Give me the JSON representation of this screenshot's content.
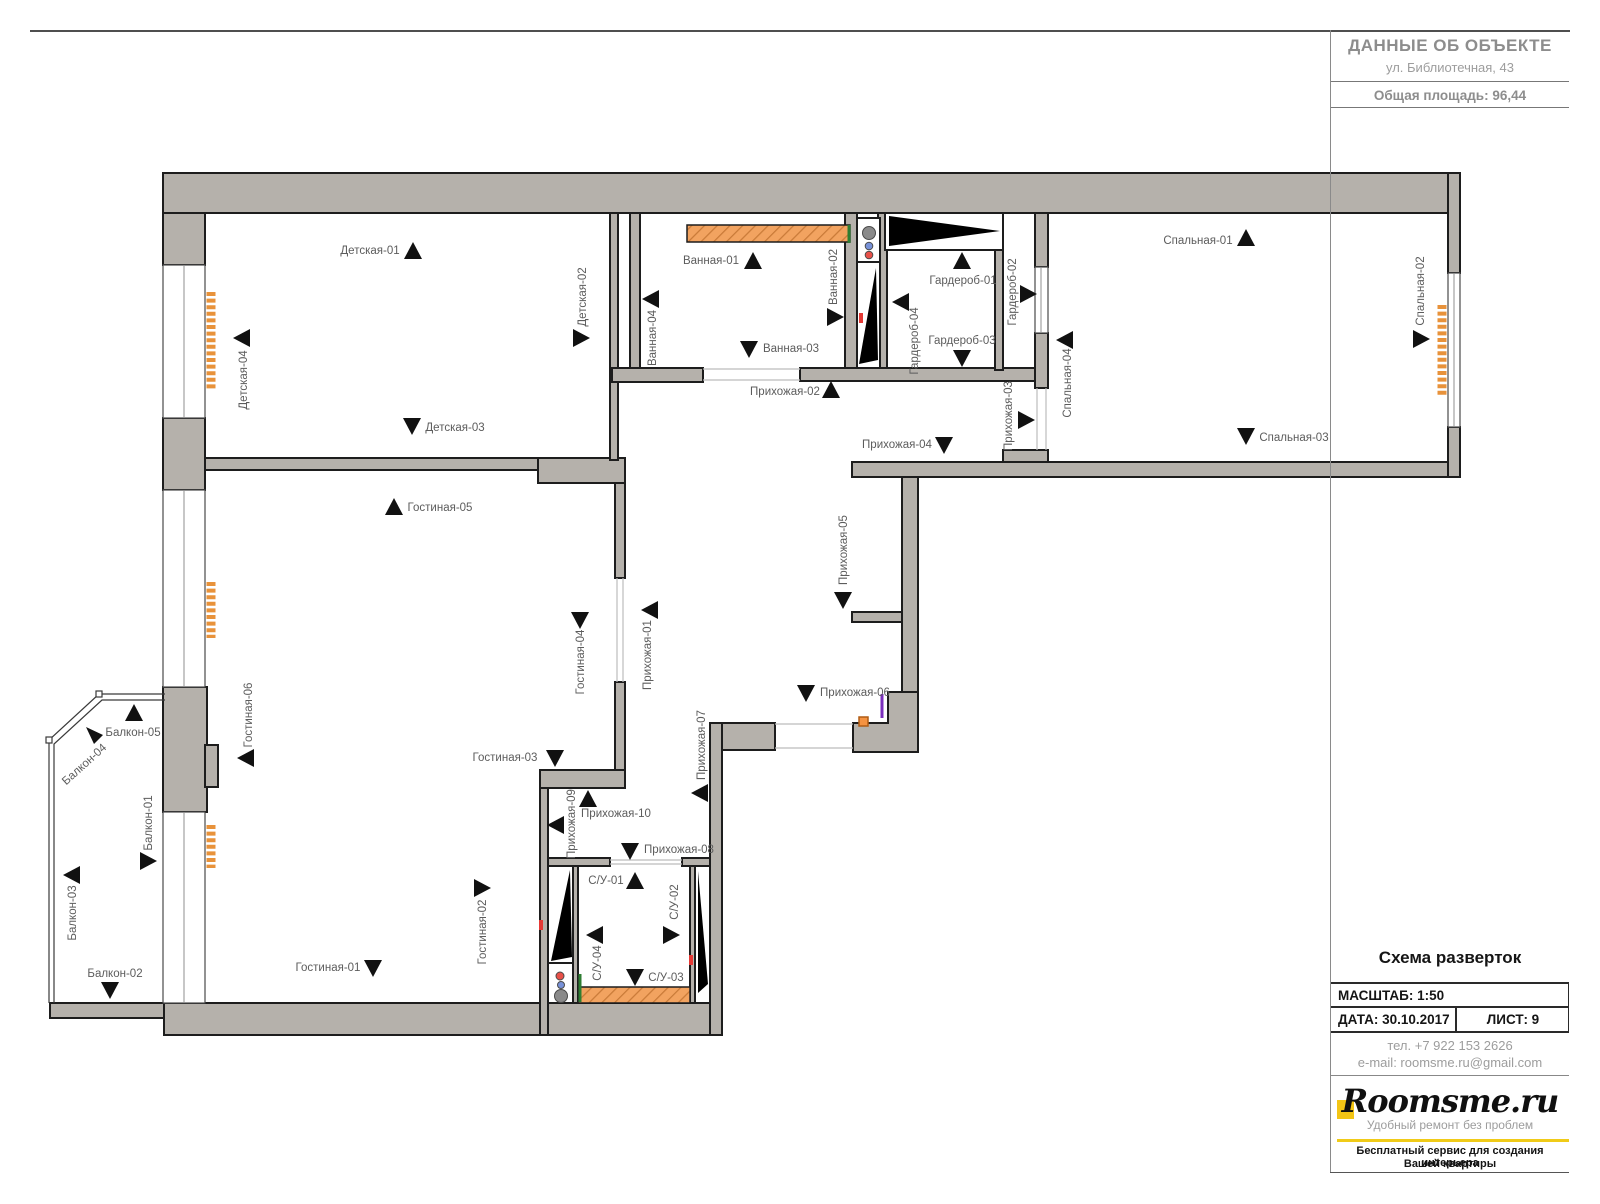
{
  "title_block": {
    "title": "ДАННЫЕ ОБ ОБЪЕКТЕ",
    "address": "ул. Библиотечная, 43",
    "area": "Общая площадь: 96,44"
  },
  "scheme_block": {
    "title": "Схема разверток",
    "scale": "МАСШТАБ: 1:50",
    "date": "ДАТА: 30.10.2017",
    "sheet": "ЛИСТ: 9",
    "phone": "тел. +7 922 153 2626",
    "email": "e-mail: roomsme.ru@gmail.com"
  },
  "logo": {
    "name": "Roomsme.ru",
    "tagline": "Удобный ремонт без проблем",
    "subtitle_line1": "Бесплатный сервис для создания интерьера",
    "subtitle_line2": "Вашей квартиры"
  },
  "colors": {
    "wall_gray": "#b5b1ab",
    "outline_black": "#1d1d1d",
    "accent_yellow": "#f3c515",
    "bath_hatch_orange": "#f2a360",
    "radiator_orange": "#e8923a",
    "riser_red": "#e85048",
    "riser_blue": "#7791d8",
    "riser_gray": "#8a8a8a",
    "tick_green": "#2e7d32",
    "tick_purple": "#7b2fbe",
    "label_gray": "#5c5c5c"
  },
  "floorplan": {
    "markers": [
      {
        "label": "Детская-01",
        "lx": 370,
        "ly": 250,
        "lr": "h",
        "tx": 413,
        "ty": 251,
        "dir": "up"
      },
      {
        "label": "Детская-02",
        "lx": 582,
        "ly": 297,
        "lr": "v",
        "tx": 581,
        "ty": 338,
        "dir": "right"
      },
      {
        "label": "Детская-03",
        "lx": 455,
        "ly": 427,
        "lr": "h",
        "tx": 412,
        "ty": 426,
        "dir": "down"
      },
      {
        "label": "Детская-04",
        "lx": 243,
        "ly": 380,
        "lr": "v",
        "tx": 242,
        "ty": 338,
        "dir": "left"
      },
      {
        "label": "Гостиная-05",
        "lx": 440,
        "ly": 507,
        "lr": "h",
        "tx": 394,
        "ty": 507,
        "dir": "up"
      },
      {
        "label": "Гостиная-04",
        "lx": 580,
        "ly": 662,
        "lr": "v",
        "tx": 580,
        "ty": 620,
        "dir": "down"
      },
      {
        "label": "Гостиная-06",
        "lx": 248,
        "ly": 715,
        "lr": "v",
        "tx": 246,
        "ty": 758,
        "dir": "left"
      },
      {
        "label": "Гостиная-03",
        "lx": 505,
        "ly": 757,
        "lr": "h",
        "tx": 555,
        "ty": 758,
        "dir": "down"
      },
      {
        "label": "Гостиная-02",
        "lx": 482,
        "ly": 932,
        "lr": "v",
        "tx": 482,
        "ty": 888,
        "dir": "right"
      },
      {
        "label": "Гостиная-01",
        "lx": 328,
        "ly": 967,
        "lr": "h",
        "tx": 373,
        "ty": 968,
        "dir": "down"
      },
      {
        "label": "Балкон-05",
        "lx": 133,
        "ly": 732,
        "lr": "h",
        "tx": 134,
        "ty": 713,
        "dir": "up"
      },
      {
        "label": "Балкон-04",
        "lx": 84,
        "ly": 764,
        "lr": "d",
        "tx": 94,
        "ty": 735,
        "dir": "upleft"
      },
      {
        "label": "Балкон-01",
        "lx": 148,
        "ly": 823,
        "lr": "v",
        "tx": 148,
        "ty": 861,
        "dir": "right"
      },
      {
        "label": "Балкон-03",
        "lx": 72,
        "ly": 913,
        "lr": "v",
        "tx": 72,
        "ty": 875,
        "dir": "left"
      },
      {
        "label": "Балкон-02",
        "lx": 115,
        "ly": 973,
        "lr": "h",
        "tx": 110,
        "ty": 990,
        "dir": "down"
      },
      {
        "label": "Ванная-01",
        "lx": 711,
        "ly": 260,
        "lr": "h",
        "tx": 753,
        "ty": 261,
        "dir": "up"
      },
      {
        "label": "Ванная-02",
        "lx": 833,
        "ly": 277,
        "lr": "v",
        "tx": 835,
        "ty": 317,
        "dir": "right"
      },
      {
        "label": "Ванная-03",
        "lx": 791,
        "ly": 348,
        "lr": "h",
        "tx": 749,
        "ty": 349,
        "dir": "down"
      },
      {
        "label": "Ванная-04",
        "lx": 652,
        "ly": 338,
        "lr": "v",
        "tx": 651,
        "ty": 299,
        "dir": "left"
      },
      {
        "label": "Гардероб-01",
        "lx": 963,
        "ly": 280,
        "lr": "h",
        "tx": 962,
        "ty": 261,
        "dir": "up"
      },
      {
        "label": "Гардероб-02",
        "lx": 1012,
        "ly": 292,
        "lr": "v",
        "tx": 1028,
        "ty": 294,
        "dir": "right"
      },
      {
        "label": "Гардероб-03",
        "lx": 962,
        "ly": 340,
        "lr": "h",
        "tx": 962,
        "ty": 358,
        "dir": "down"
      },
      {
        "label": "Гардероб-04",
        "lx": 914,
        "ly": 341,
        "lr": "v",
        "tx": 901,
        "ty": 302,
        "dir": "left"
      },
      {
        "label": "Спальная-01",
        "lx": 1198,
        "ly": 240,
        "lr": "h",
        "tx": 1246,
        "ty": 238,
        "dir": "up"
      },
      {
        "label": "Спальная-02",
        "lx": 1420,
        "ly": 291,
        "lr": "v",
        "tx": 1421,
        "ty": 339,
        "dir": "right"
      },
      {
        "label": "Спальная-03",
        "lx": 1294,
        "ly": 437,
        "lr": "h",
        "tx": 1246,
        "ty": 436,
        "dir": "down"
      },
      {
        "label": "Спальная-04",
        "lx": 1067,
        "ly": 383,
        "lr": "v",
        "tx": 1065,
        "ty": 340,
        "dir": "left"
      },
      {
        "label": "Прихожая-01",
        "lx": 647,
        "ly": 655,
        "lr": "v",
        "tx": 650,
        "ty": 610,
        "dir": "left"
      },
      {
        "label": "Прихожая-02",
        "lx": 785,
        "ly": 391,
        "lr": "h",
        "tx": 831,
        "ty": 390,
        "dir": "up"
      },
      {
        "label": "Прихожая-03",
        "lx": 1008,
        "ly": 416,
        "lr": "v",
        "tx": 1026,
        "ty": 420,
        "dir": "right"
      },
      {
        "label": "Прихожая-04",
        "lx": 897,
        "ly": 444,
        "lr": "h",
        "tx": 944,
        "ty": 445,
        "dir": "down"
      },
      {
        "label": "Прихожая-05",
        "lx": 843,
        "ly": 550,
        "lr": "v",
        "tx": 843,
        "ty": 600,
        "dir": "down"
      },
      {
        "label": "Прихожая-06",
        "lx": 855,
        "ly": 692,
        "lr": "h",
        "tx": 806,
        "ty": 693,
        "dir": "down"
      },
      {
        "label": "Прихожая-07",
        "lx": 701,
        "ly": 745,
        "lr": "v",
        "tx": 700,
        "ty": 793,
        "dir": "left"
      },
      {
        "label": "Прихожая-08",
        "lx": 679,
        "ly": 849,
        "lr": "h",
        "tx": 630,
        "ty": 851,
        "dir": "down"
      },
      {
        "label": "Прихожая-09",
        "lx": 571,
        "ly": 824,
        "lr": "v",
        "tx": 556,
        "ty": 825,
        "dir": "left"
      },
      {
        "label": "Прихожая-10",
        "lx": 616,
        "ly": 813,
        "lr": "h",
        "tx": 588,
        "ty": 799,
        "dir": "up"
      },
      {
        "label": "С/У-01",
        "lx": 606,
        "ly": 880,
        "lr": "h",
        "tx": 635,
        "ty": 881,
        "dir": "up"
      },
      {
        "label": "С/У-02",
        "lx": 674,
        "ly": 902,
        "lr": "v",
        "tx": 671,
        "ty": 935,
        "dir": "right"
      },
      {
        "label": "С/У-03",
        "lx": 666,
        "ly": 977,
        "lr": "h",
        "tx": 635,
        "ty": 977,
        "dir": "down"
      },
      {
        "label": "С/У-04",
        "lx": 597,
        "ly": 963,
        "lr": "v",
        "tx": 595,
        "ty": 935,
        "dir": "left"
      }
    ]
  }
}
